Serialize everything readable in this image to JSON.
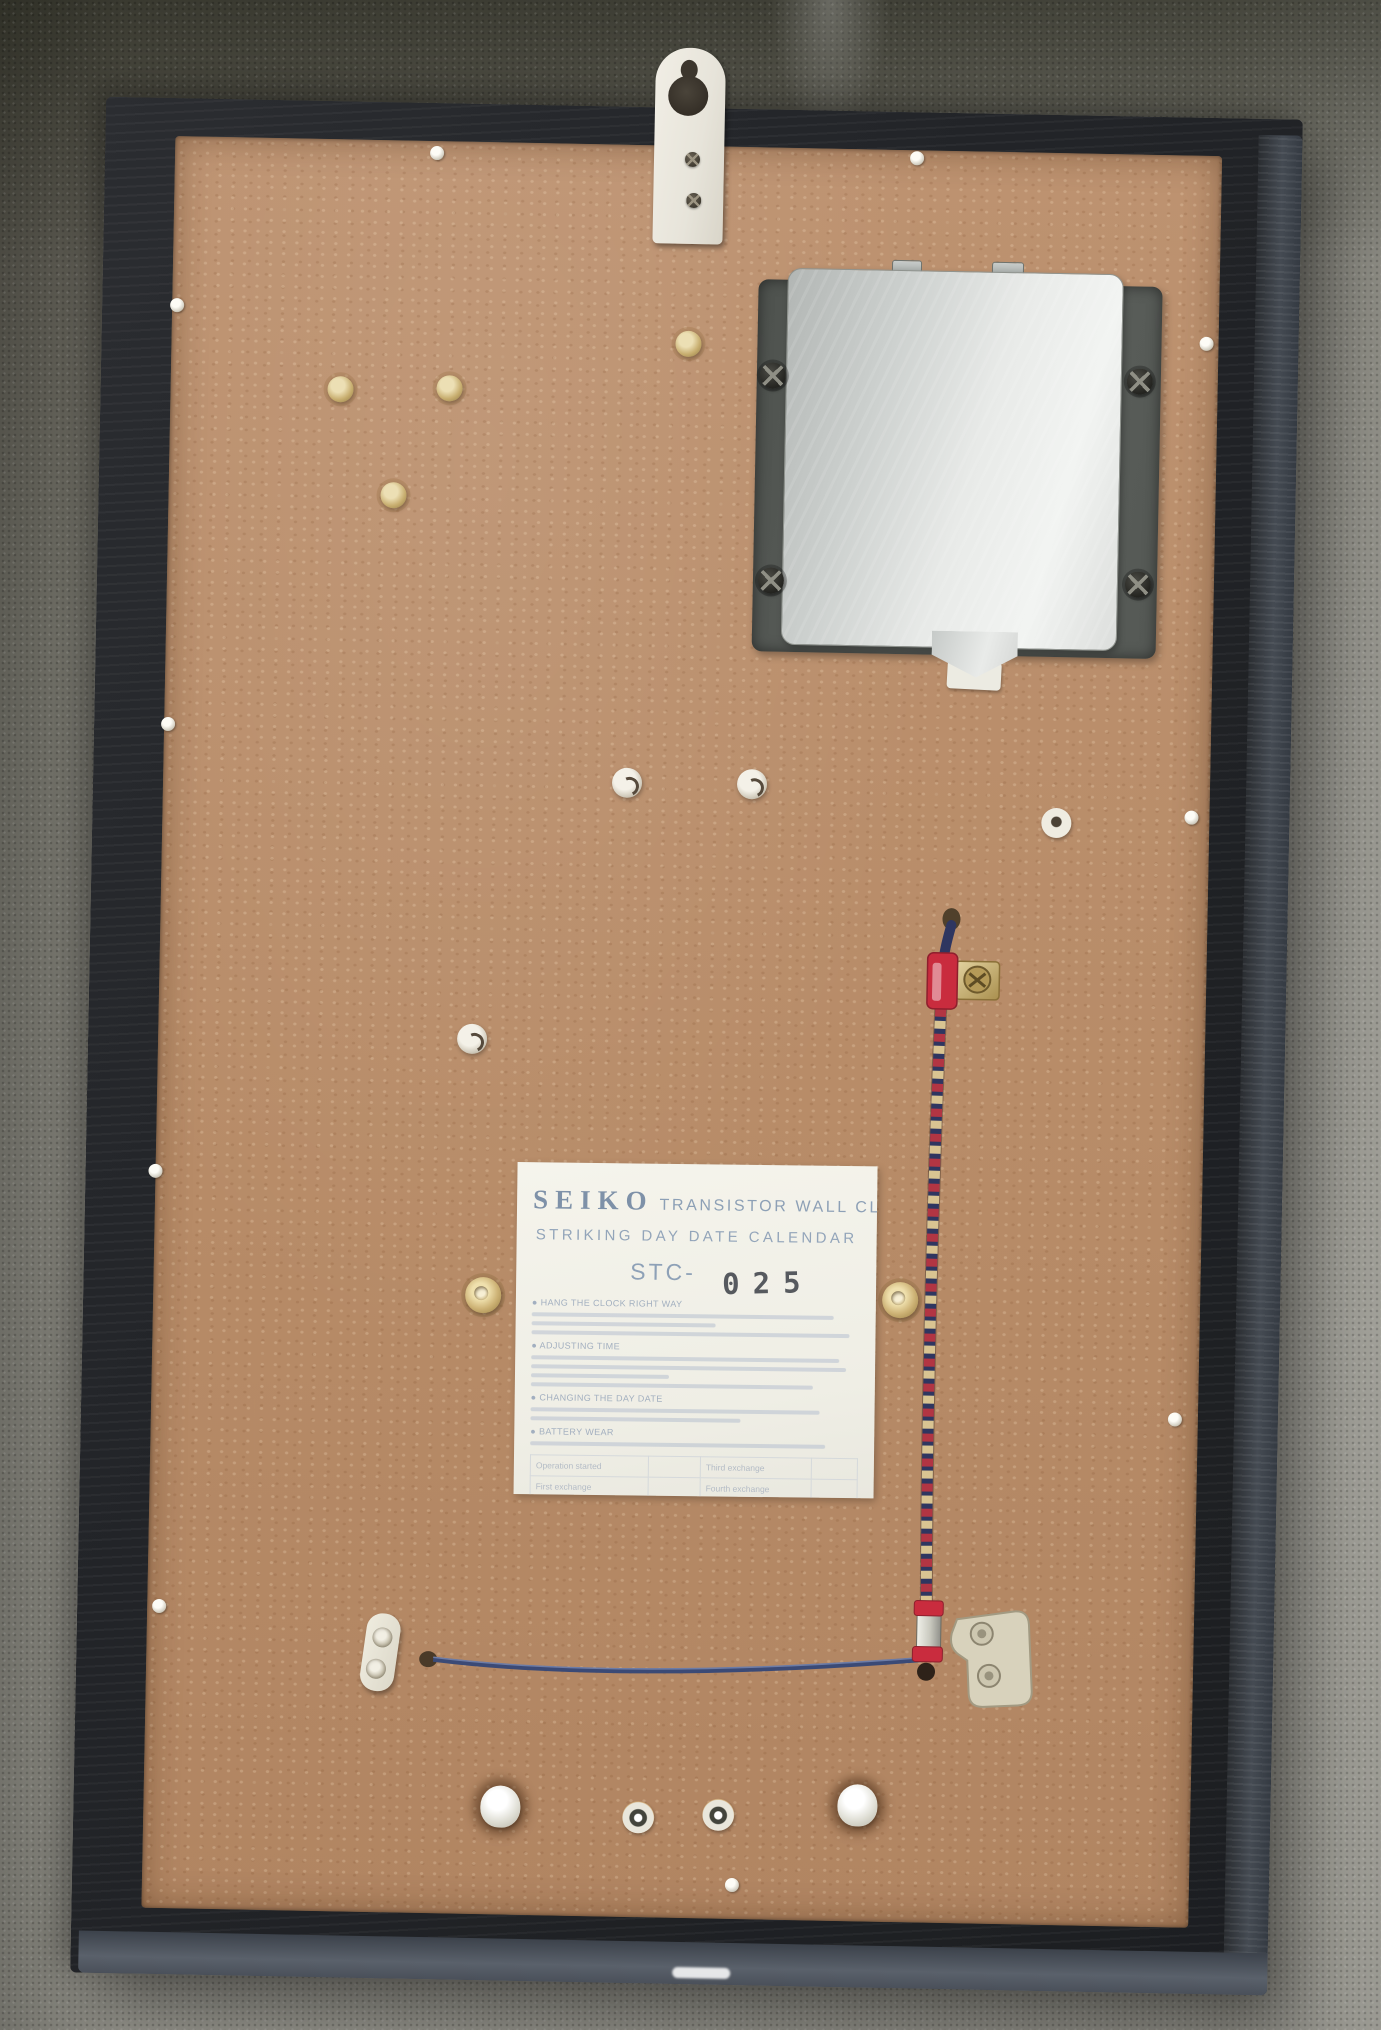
{
  "scene": {
    "description": "Rear view of a Seiko transistor wall clock: black wooden frame with brown hardboard back panel resting on gray carpet, white keyhole hanging bracket at top, aluminum battery compartment cover at top right, white instruction label at center, twisted pendulum cord with red clamps on the right, thin blue wire and metal brackets near the bottom."
  },
  "label": {
    "brand": "SEIKO",
    "product": "TRANSISTOR WALL CLOCK",
    "subtitle": "STRIKING DAY DATE CALENDAR",
    "model_prefix": "STC-",
    "model_number": "025",
    "sections": [
      {
        "heading": "● HANG THE CLOCK RIGHT WAY"
      },
      {
        "heading": "● ADJUSTING TIME"
      },
      {
        "heading": "● CHANGING THE DAY DATE"
      },
      {
        "heading": "● BATTERY WEAR"
      }
    ],
    "battery_table": {
      "left": [
        "Operation started",
        "First exchange",
        "Second exchange"
      ],
      "right": [
        "Third exchange",
        "Fourth exchange",
        "Fifth exchange"
      ]
    }
  },
  "colors": {
    "carpet": "#8d8c84",
    "frame": "#26282b",
    "board": "#b98e6b",
    "label_paper": "#f2f1e8",
    "label_ink": "#8da0b6",
    "stamp_ink": "#41454c",
    "cord_navy": "#2f3660",
    "cord_red": "#b23543",
    "cord_cream": "#d9c492",
    "clamp_red": "#c92c3e",
    "battery_cover": "#dfe1df"
  }
}
